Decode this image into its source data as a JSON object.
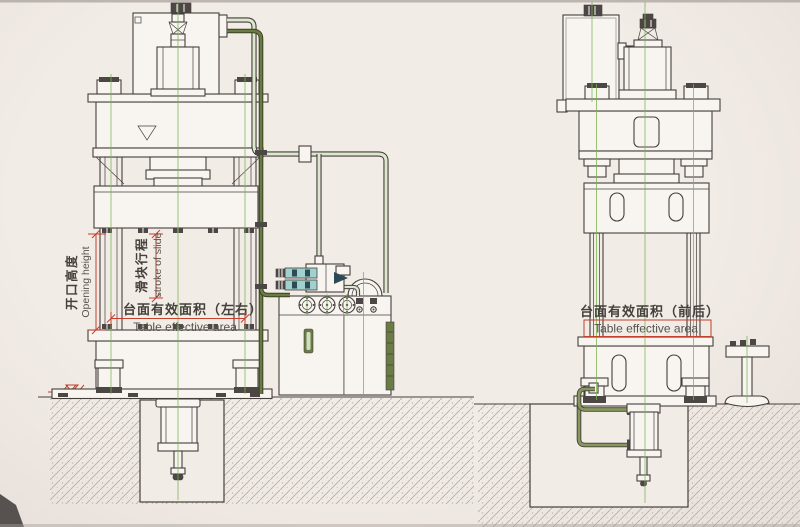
{
  "drawing": {
    "labels": {
      "opening_height_zh": "开口高度",
      "opening_height_en": "Opening height",
      "stroke_zh": "滑块行程",
      "stroke_en": "stroke of slide",
      "table_lr_zh": "台面有效面积（左右）",
      "table_lr_en": "Table effective area",
      "table_fb_zh": "台面有效面积（前后）",
      "table_fb_en": "Table effective area"
    },
    "colors": {
      "line": "#453f3c",
      "dark": "#4c4744",
      "fill": "#f8f5f1",
      "paper": "#f2ece7",
      "paper_edge": "#e6ded8",
      "centerline": "#79b254",
      "dimension": "#c4402c",
      "pipe_dark": "#6b7b45",
      "pipe_dark_edge": "#39411f",
      "pipe_mid": "#87985c",
      "pipe_light": "#dde6cf",
      "valve": "#9fd2ce",
      "valve_dark": "#2e4a56",
      "hatch": "#b7aea8",
      "text_zh": "#44403b",
      "text_en": "#57524d"
    }
  }
}
